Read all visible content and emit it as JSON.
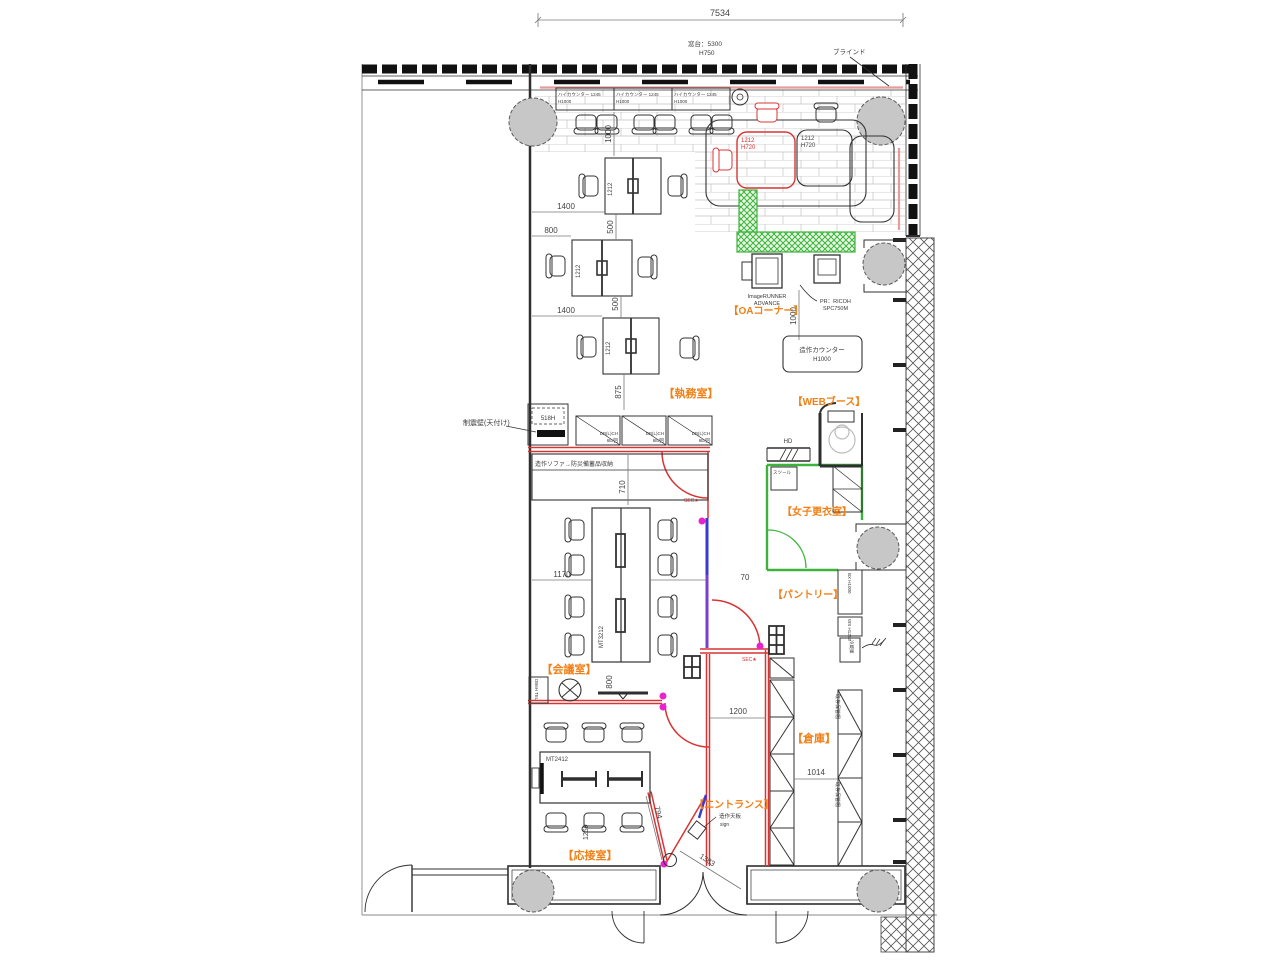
{
  "colors": {
    "red": "#d93434",
    "green": "#3cb43c",
    "blue": "#3a3ad0",
    "purple": "#7a3fd0",
    "orange": "#f08018",
    "magenta": "#e822cc",
    "column": "#c7c7c7",
    "pink": "#e89b9b",
    "line": "#2f2f2f"
  },
  "rooms": {
    "office": "【執務室】",
    "meeting": "【会議室】",
    "reception": "【応接室】",
    "entrance": "【エントランス】",
    "storage": "【倉庫】",
    "pantry": "【パントリー】",
    "womens_locker": "【女子更衣室】",
    "web_booth": "【WEBブース】",
    "oa_corner": "【OAコーナー】"
  },
  "dims": {
    "overall": "7534",
    "d1400": "1400",
    "d800": "800",
    "d500": "500",
    "d875": "875",
    "d1000": "1000",
    "d1212": "1212",
    "d710": "710",
    "d1170": "1170",
    "d70": "70",
    "d1200": "1200",
    "d1014": "1014",
    "d794": "794",
    "d1383": "1383",
    "d1250": "1250"
  },
  "annotations": {
    "window_sill": "窓台：5300",
    "window_sill_h": "H750",
    "blind": "ブラインド",
    "hi_counter": "ハイカウンター 1245",
    "h1000": "H1000",
    "table_1212": "1212",
    "table_h720": "H720",
    "copier1": "ImageRUNNER",
    "copier2": "ADVANCE",
    "printer1": "PR：RICOH",
    "printer2": "SPC750M",
    "zosaku_counter": "造作カウンター",
    "counter_h": "H1000",
    "seishin": "制震壁(天付け)",
    "c518": "518H",
    "locker1": "DB(L)CH",
    "locker2": "6E/回",
    "sofa": "造作ソファ→防災備蓄品収納",
    "sec": "SEC★",
    "hd": "HD",
    "stool": "スツール",
    "bx": "BX H1000",
    "ws": "WS H1263",
    "fridge": "冷蔵庫",
    "mt3212": "MT3212",
    "mt2412": "MT2412",
    "db6h": "DB6H TEL",
    "exist_shelf": "既存保管棚",
    "tenban": "造作天板",
    "sign": "sign"
  }
}
